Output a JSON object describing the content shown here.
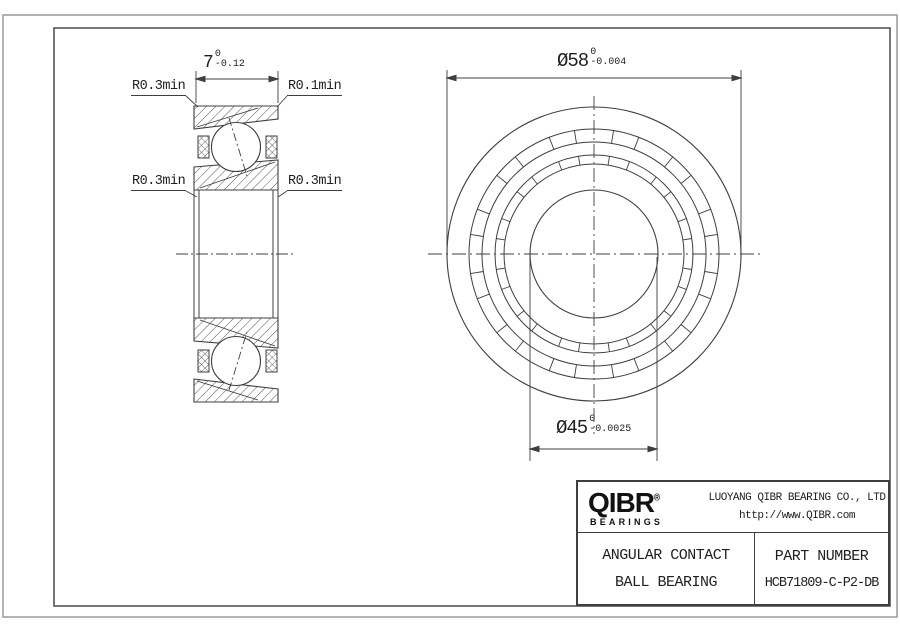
{
  "drawing": {
    "section_view": {
      "width_dim": {
        "value": "7",
        "tol_upper": "0",
        "tol_lower": "-0.12"
      },
      "labels": {
        "outer_left": "R0.3min",
        "outer_right": "R0.1min",
        "inner_left": "R0.3min",
        "inner_right": "R0.3min"
      }
    },
    "front_view": {
      "outer_diameter_dim": {
        "value": "Ø58",
        "tol_upper": "0",
        "tol_lower": "-0.004"
      },
      "bore_diameter_dim": {
        "value": "Ø45",
        "tol_upper": "0",
        "tol_lower": "-0.0025"
      }
    }
  },
  "title_block": {
    "brand": {
      "logo_text": "QIBR",
      "registered_mark": "®",
      "logo_subtext": "BEARINGS"
    },
    "company_name": "LUOYANG QIBR BEARING CO., LTD",
    "website": "http://www.QIBR.com",
    "product_line1": "ANGULAR CONTACT",
    "product_line2": "BALL BEARING",
    "part_number_label": "PART NUMBER",
    "part_number_value": "HCB71809-C-P2-DB"
  },
  "colors": {
    "line": "#3f3f3f",
    "frame_outer": "#9a9a9a",
    "frame_inner": "#555555",
    "text": "#1f1f1f",
    "background": "#ffffff"
  }
}
